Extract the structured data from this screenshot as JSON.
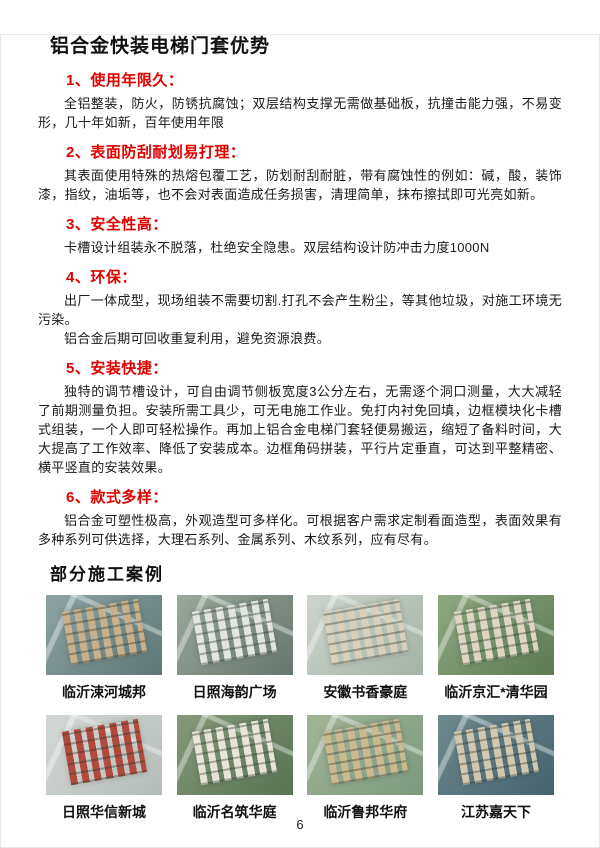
{
  "title": "铝合金快装电梯门套优势",
  "sections": [
    {
      "heading": "1、使用年限久：",
      "p1": "全铝整装，防火，防锈抗腐蚀；双层结构支撑无需做基础板，抗撞击能力强，不易变形，几十年如新，百年使用年限"
    },
    {
      "heading": "2、表面防刮耐划易打理：",
      "p1": "其表面使用特殊的热熔包覆工艺，防划耐刮耐脏，带有腐蚀性的例如：碱，酸，装饰漆，指纹，油垢等，也不会对表面造成任务损害，清理简单，抹布擦拭即可光亮如新。"
    },
    {
      "heading": "3、安全性高：",
      "p1": "卡槽设计组装永不脱落，杜绝安全隐患。双层结构设计防冲击力度1000N"
    },
    {
      "heading": "4、环保：",
      "p1": "出厂一体成型，现场组装不需要切割.打孔不会产生粉尘，等其他垃圾，对施工环境无污染。",
      "p2": "铝合金后期可回收重复利用，避免资源浪费。"
    },
    {
      "heading": "5、安装快捷：",
      "p1": "独特的调节槽设计，可自由调节侧板宽度3公分左右，无需逐个洞口测量，大大减轻了前期测量负担。安装所需工具少，可无电施工作业。免打内衬免回填，边框模块化卡槽式组装，一个人即可轻松操作。再加上铝合金电梯门套轻便易搬运，缩短了备料时间，大大提高了工作效率、降低了安装成本。边框角码拼装，平行片定垂直，可达到平整精密、横平竖直的安装效果。"
    },
    {
      "heading": "6、款式多样：",
      "p1": "铝合金可塑性极高，外观造型可多样化。可根据客户需求定制看面造型，表面效果有多种系列可供选择，大理石系列、金属系列、木纹系列，应有尽有。"
    }
  ],
  "cases": {
    "heading": "部分施工案例",
    "items": [
      {
        "label": "临沂涑河城邦"
      },
      {
        "label": "日照海韵广场"
      },
      {
        "label": "安徽书香豪庭"
      },
      {
        "label": "临沂京汇*清华园"
      },
      {
        "label": "日照华信新城"
      },
      {
        "label": "临沂名筑华庭"
      },
      {
        "label": "临沂鲁邦华府"
      },
      {
        "label": "江苏嘉天下"
      }
    ]
  },
  "page": {
    "number": "6"
  },
  "colors": {
    "accent_red": "#e00000",
    "text": "#1a1a1a"
  }
}
